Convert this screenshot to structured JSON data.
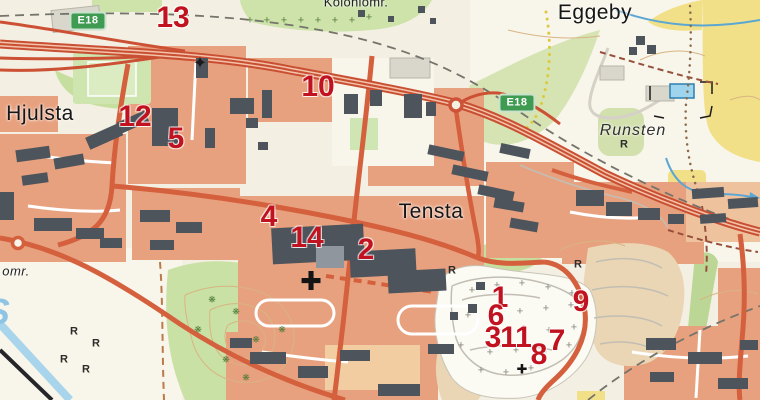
{
  "map": {
    "place_labels": [
      {
        "id": "hjulsta",
        "text": "Hjulsta",
        "x": 40,
        "y": 114,
        "style": "place"
      },
      {
        "id": "tensta",
        "text": "Tensta",
        "x": 431,
        "y": 212,
        "style": "place"
      },
      {
        "id": "eggeby",
        "text": "Eggeby",
        "x": 595,
        "y": 13,
        "style": "place"
      },
      {
        "id": "runsten",
        "text": "Runsten",
        "x": 633,
        "y": 131,
        "style": "area-italic"
      },
      {
        "id": "koloniomr",
        "text": "Koloniomr.",
        "x": 356,
        "y": 2,
        "style": "small"
      },
      {
        "id": "omr-fragment",
        "text": "omr.",
        "x": 16,
        "y": 271,
        "style": "small-italic"
      },
      {
        "id": "water-label-fragment",
        "text": "S",
        "x": -2,
        "y": 312,
        "style": "water"
      }
    ],
    "road_shields": [
      {
        "text": "E18",
        "x": 88,
        "y": 21
      },
      {
        "text": "E18",
        "x": 517,
        "y": 103
      }
    ],
    "markers": [
      {
        "label": "1",
        "x": 500,
        "y": 298
      },
      {
        "label": "2",
        "x": 366,
        "y": 250
      },
      {
        "label": "3",
        "x": 493,
        "y": 338
      },
      {
        "label": "4",
        "x": 269,
        "y": 217
      },
      {
        "label": "5",
        "x": 176,
        "y": 139
      },
      {
        "label": "6",
        "x": 496,
        "y": 316
      },
      {
        "label": "7",
        "x": 557,
        "y": 341
      },
      {
        "label": "8",
        "x": 539,
        "y": 355
      },
      {
        "label": "9",
        "x": 581,
        "y": 302
      },
      {
        "label": "10",
        "x": 318,
        "y": 87
      },
      {
        "label": "11",
        "x": 516,
        "y": 338
      },
      {
        "label": "12",
        "x": 135,
        "y": 117
      },
      {
        "label": "13",
        "x": 173,
        "y": 18
      },
      {
        "label": "14",
        "x": 307,
        "y": 238
      }
    ],
    "symbols": {
      "grave_crosses": [
        [
          472,
          291
        ],
        [
          497,
          286
        ],
        [
          522,
          284
        ],
        [
          548,
          288
        ],
        [
          572,
          294
        ],
        [
          468,
          316
        ],
        [
          520,
          312
        ],
        [
          546,
          309
        ],
        [
          571,
          306
        ],
        [
          498,
          331
        ],
        [
          524,
          329
        ],
        [
          549,
          331
        ],
        [
          574,
          328
        ],
        [
          461,
          346
        ],
        [
          490,
          353
        ],
        [
          516,
          351
        ],
        [
          544,
          353
        ],
        [
          569,
          346
        ],
        [
          481,
          371
        ],
        [
          506,
          373
        ],
        [
          531,
          369
        ]
      ],
      "allotment_trees": [
        [
          250,
          21
        ],
        [
          267,
          21
        ],
        [
          284,
          21
        ],
        [
          301,
          21
        ],
        [
          318,
          21
        ],
        [
          335,
          21
        ],
        [
          352,
          21
        ],
        [
          369,
          18
        ]
      ],
      "hill_trees": [
        [
          212,
          300
        ],
        [
          236,
          312
        ],
        [
          256,
          340
        ],
        [
          226,
          360
        ],
        [
          282,
          330
        ],
        [
          246,
          378
        ],
        [
          198,
          330
        ]
      ],
      "ancient_remains": [
        [
          452,
          271
        ],
        [
          74,
          332
        ],
        [
          96,
          344
        ],
        [
          64,
          360
        ],
        [
          86,
          370
        ],
        [
          578,
          265
        ],
        [
          624,
          145
        ]
      ],
      "church_crosses": [
        [
          311,
          281
        ]
      ],
      "small_church_crosses": [
        [
          522,
          369
        ]
      ],
      "star_symbols": [
        [
          200,
          63
        ]
      ]
    },
    "colors": {
      "marker_red": "#c0121f",
      "shield_green": "#3f9b52",
      "road_orange": "#d4603e",
      "highway_orange": "#cc5033",
      "residential_orange": "#e8a17f",
      "green_area": "#cde3aa",
      "yellow_field": "#f2e089",
      "building_gray": "#4e545c",
      "water_blue": "#5aa7d4",
      "base_cream": "#f3efe2"
    }
  }
}
